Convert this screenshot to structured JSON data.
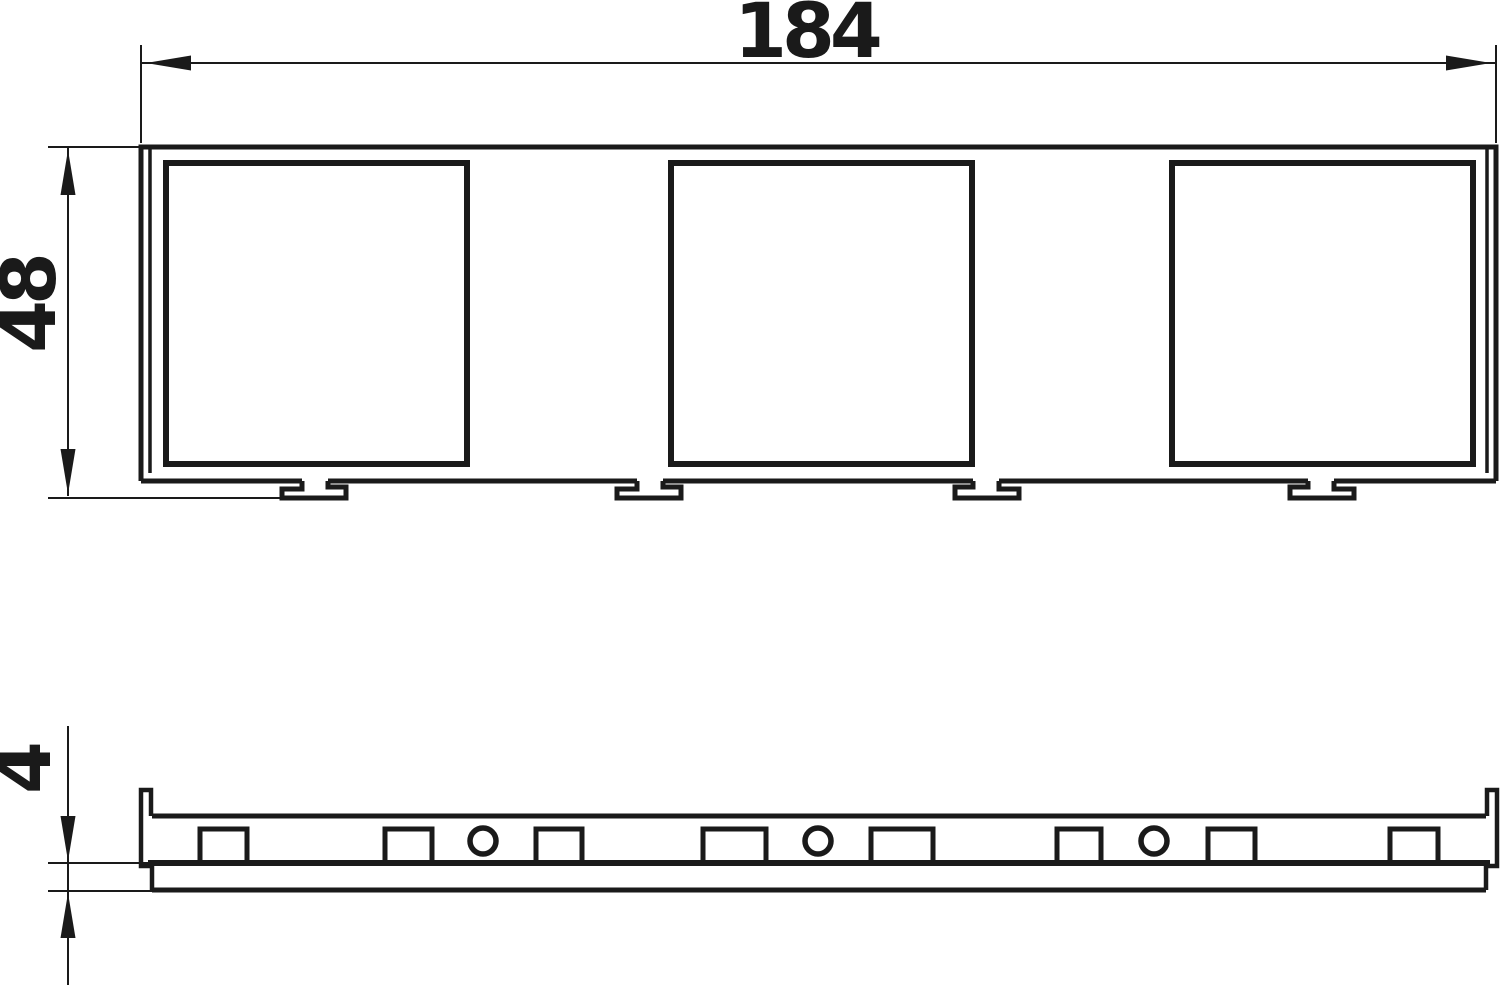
{
  "drawing": {
    "title": "3-gang device frame dimension drawing",
    "line_color": "#1a1a1a",
    "background": "#ffffff",
    "dimensions": {
      "width": {
        "label": "184"
      },
      "height": {
        "label": "48"
      },
      "thickness": {
        "label": "4"
      }
    },
    "views": {
      "top": {
        "frame": {
          "left": 141,
          "top": 147,
          "right": 1496,
          "bottom": 481,
          "stroke": 5
        },
        "rim_lines": [
          {
            "x": 150,
            "y1": 149,
            "y2": 473
          },
          {
            "x": 1487,
            "y1": 149,
            "y2": 473
          }
        ],
        "openings": [
          {
            "x": 166,
            "y": 163,
            "w": 301,
            "h": 301
          },
          {
            "x": 671,
            "y": 163,
            "w": 301,
            "h": 301
          },
          {
            "x": 1172,
            "y": 163,
            "w": 301,
            "h": 301
          }
        ],
        "openings_stroke": 6,
        "feet": [
          {
            "c": 315,
            "dir": 1
          },
          {
            "c": 650,
            "dir": 1
          },
          {
            "c": 986,
            "dir": -1
          },
          {
            "c": 1321,
            "dir": -1
          }
        ],
        "foot_geom": {
          "half_stem": 13,
          "flange_out": 33,
          "lip_in": 31,
          "y_top": 481,
          "y_step": 489,
          "y_bottom": 498,
          "y_lip": 487
        }
      },
      "side": {
        "strip": {
          "x1": 152,
          "x2": 1486,
          "top": 816,
          "bottom": 863,
          "stroke": 5
        },
        "plate": {
          "x1": 152,
          "x2": 1486,
          "bottom": 890,
          "stroke": 5
        },
        "left_end": [
          [
            151,
            816
          ],
          [
            151,
            790
          ],
          [
            141,
            790
          ],
          [
            141,
            866
          ],
          [
            152,
            866
          ],
          [
            152,
            890
          ]
        ],
        "right_end": [
          [
            1487,
            816
          ],
          [
            1487,
            790
          ],
          [
            1497,
            790
          ],
          [
            1497,
            866
          ],
          [
            1486,
            866
          ],
          [
            1486,
            890
          ]
        ],
        "clips": [
          {
            "x": 200,
            "w": 47
          },
          {
            "x": 385,
            "w": 47
          },
          {
            "x": 536,
            "w": 46
          },
          {
            "x": 703,
            "w": 63
          },
          {
            "x": 871,
            "w": 62
          },
          {
            "x": 1057,
            "w": 44
          },
          {
            "x": 1208,
            "w": 47
          },
          {
            "x": 1390,
            "w": 48
          }
        ],
        "clip_y": 829,
        "clip_h": 34,
        "clip_stroke": 5,
        "holes": [
          {
            "cx": 483
          },
          {
            "cx": 818
          },
          {
            "cx": 1154
          }
        ],
        "hole_cy": 841,
        "hole_r": 13,
        "hole_stroke": 5.5
      },
      "dims_geometry": {
        "width": {
          "line": {
            "x1": 141,
            "y": 63,
            "x2": 1496
          },
          "ext": [
            {
              "x": 141,
              "y1": 45,
              "y2": 143
            },
            {
              "x": 1496,
              "y1": 45,
              "y2": 143
            }
          ],
          "arrows": [
            {
              "tx": 146,
              "ty": 63,
              "dx": 1,
              "dy": 0
            },
            {
              "tx": 1491,
              "ty": 63,
              "dx": -1,
              "dy": 0
            }
          ],
          "label_pos": {
            "x": 806,
            "y": 57
          }
        },
        "height": {
          "line": {
            "x": 68,
            "y1": 147,
            "y2": 496
          },
          "ext": [
            {
              "y": 147,
              "x1": 48,
              "x2": 140
            },
            {
              "y": 498,
              "x1": 48,
              "x2": 283
            }
          ],
          "arrows": [
            {
              "tx": 68,
              "ty": 150,
              "dx": 0,
              "dy": 1
            },
            {
              "tx": 68,
              "ty": 494,
              "dx": 0,
              "dy": -1
            }
          ],
          "label_pos": {
            "x": 55,
            "y": 305
          }
        },
        "thickness": {
          "line": {
            "x": 68,
            "y1": 726,
            "y2": 985
          },
          "ext": [
            {
              "y": 863,
              "x1": 48,
              "x2": 152
            },
            {
              "y": 891,
              "x1": 48,
              "x2": 152
            }
          ],
          "arrows": [
            {
              "tx": 68,
              "ty": 861,
              "dx": 0,
              "dy": -1
            },
            {
              "tx": 68,
              "ty": 893,
              "dx": 0,
              "dy": 1
            }
          ],
          "label_pos": {
            "x": 50,
            "y": 770
          }
        },
        "thin_stroke": 2,
        "arrow_len": 45,
        "arrow_halfwidth": 7.5
      }
    }
  }
}
